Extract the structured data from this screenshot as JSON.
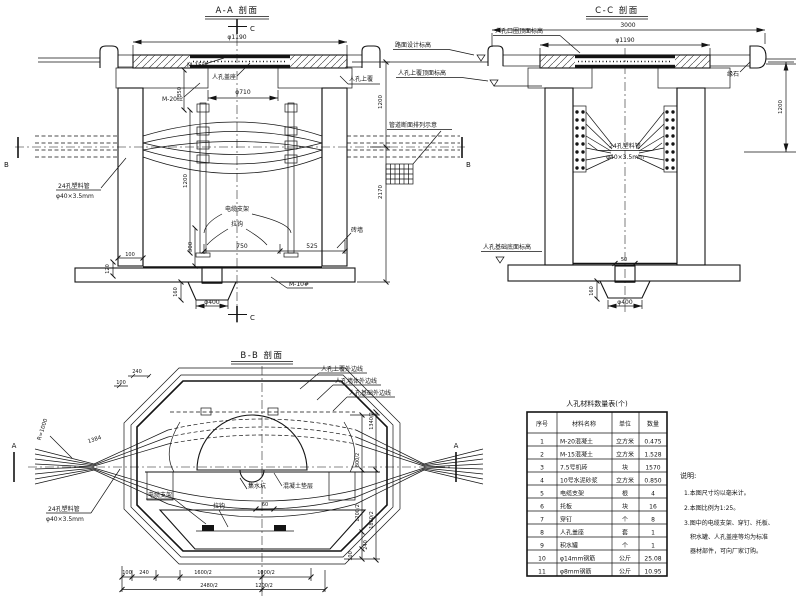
{
  "aa": {
    "title": "A-A 剖面",
    "marker_c": "C",
    "marker_b": "B",
    "dim_phi1190": "φ1190",
    "dim_phi710": "φ710",
    "dim_350": "350",
    "dim_1200_left": "1200",
    "dim_750": "750",
    "dim_525": "525",
    "dim_300": "300",
    "dim_100": "100",
    "dim_120": "120",
    "dim_160": "160",
    "dim_phi400": "φ400",
    "dim_1200_right": "1200",
    "dim_2170": "2170",
    "label_m15": "M-15砼",
    "label_m20": "M-20砼",
    "label_m10": "M-10#",
    "label_cover_seat": "人孔盖座",
    "label_top_slab": "人孔上覆",
    "label_rack": "电缆支架",
    "label_hook": "拉钩",
    "label_brick_wall": "砖墙",
    "label_duct_line1": "24孔塑料管",
    "label_duct_line2": "φ40×3.5mm",
    "label_duct_grid": "管道断面排列示意"
  },
  "cc": {
    "title": "C-C 剖面",
    "dim_3000": "3000",
    "dim_phi1190": "φ1190",
    "dim_1200": "1200",
    "dim_50": "50",
    "dim_160": "160",
    "dim_phi400": "φ400",
    "label_road_level": "路面设计标高",
    "label_ring_level": "人孔口圈顶面标高",
    "label_slab_level": "人孔上覆顶面标高",
    "label_base_level": "人孔基础底面标高",
    "label_curb": "缘石",
    "label_duct_line1": "24孔塑料管",
    "label_duct_line2": "φ40×3.5mm"
  },
  "bb": {
    "title": "B-B 剖面",
    "marker_a": "A",
    "label_r1000": "R=1000",
    "dim_1384": "1384",
    "label_duct_line1": "24孔塑料管",
    "label_duct_line2": "φ40×3.5mm",
    "callout_top_slab": "人孔上覆外边线",
    "callout_wall": "人孔墙体外边线",
    "callout_base": "人孔基础外边线",
    "label_rack": "电缆支架",
    "label_hook": "拉钩",
    "label_sump": "集水坑",
    "label_bedding": "混凝土垫层",
    "dim_60": "60",
    "dim_top_240": "240",
    "dim_top_100": "100",
    "dims_bottom_row1": [
      "100",
      "240",
      "1600/2",
      "1000/2"
    ],
    "dims_bottom_row2": [
      "2480/2",
      "1200/2"
    ],
    "dims_right": [
      "1340/2",
      "800/2",
      "1200/2",
      "1860/2",
      "240",
      "100"
    ]
  },
  "table": {
    "title": "人孔材料数量表(个)",
    "headers": [
      "序号",
      "材料名称",
      "单位",
      "数量"
    ],
    "rows": [
      [
        "1",
        "M-20混凝土",
        "立方米",
        "0.475"
      ],
      [
        "2",
        "M-15混凝土",
        "立方米",
        "1.528"
      ],
      [
        "3",
        "7.5号机砖",
        "块",
        "1570"
      ],
      [
        "4",
        "10号水泥砂浆",
        "立方米",
        "0.850"
      ],
      [
        "5",
        "电缆支架",
        "根",
        "4"
      ],
      [
        "6",
        "托板",
        "块",
        "16"
      ],
      [
        "7",
        "穿钉",
        "个",
        "8"
      ],
      [
        "8",
        "人孔盖座",
        "套",
        "1"
      ],
      [
        "9",
        "积水罐",
        "个",
        "1"
      ],
      [
        "10",
        "φ14mm钢筋",
        "公斤",
        "25.08"
      ],
      [
        "11",
        "φ8mm钢筋",
        "公斤",
        "10.95"
      ]
    ]
  },
  "notes": {
    "heading": "说明:",
    "lines": [
      "1.本图尺寸均以毫米计。",
      "2.本图比例为1:25。",
      "3.图中的电缆支架、穿钉、托板、",
      "积水罐、人孔盖座等均为标准",
      "器材部件，可向厂家订购。"
    ]
  }
}
